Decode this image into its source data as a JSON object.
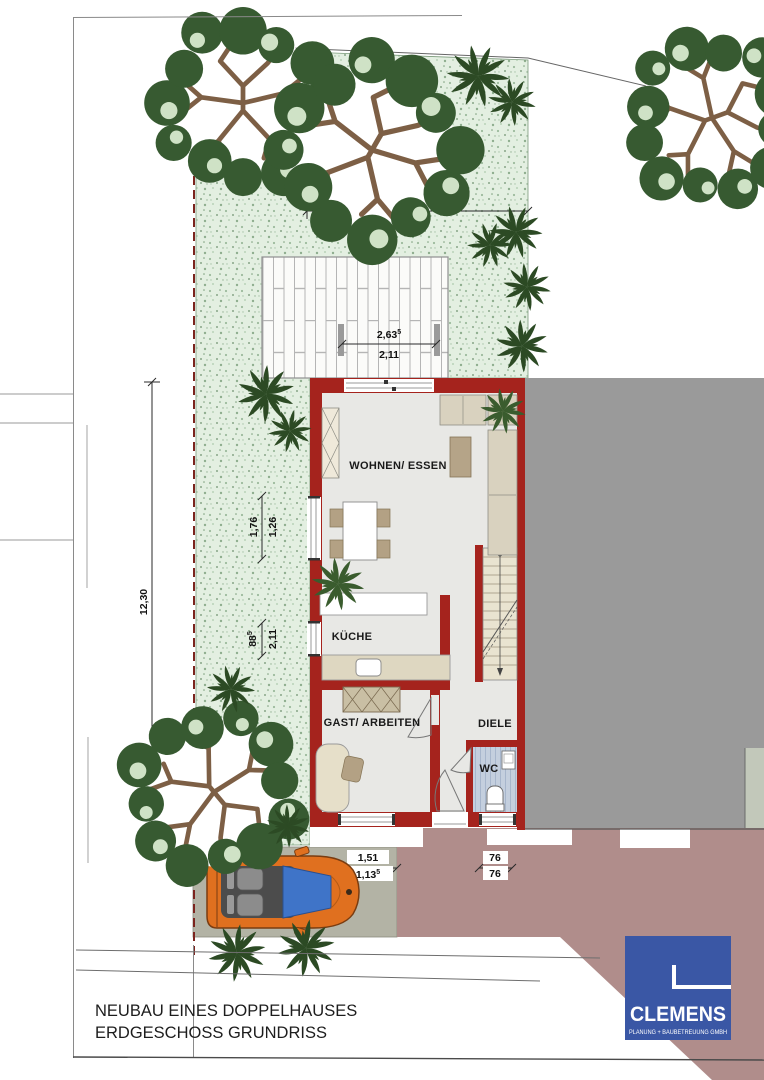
{
  "meta": {
    "drawing_type": "architectural floor plan / site plan"
  },
  "title_block": {
    "line1": "NEUBAU EINES DOPPELHAUSES",
    "line2": "ERDGESCHOSS GRUNDRISS"
  },
  "logo": {
    "name": "CLEMENS",
    "subtitle": "PLANUNG + BAUBETREUUNG GMBH"
  },
  "site": {
    "plot_label": "9/18"
  },
  "rooms": {
    "living": "WOHNEN/ ESSEN",
    "kitchen": "KÜCHE",
    "guest": "GAST/ ARBEITEN",
    "hall": "DIELE",
    "wc": "WC"
  },
  "dimensions": {
    "garden_width": "6,00",
    "garden_depth": "12,30",
    "terrace_upper": {
      "value": "2,63",
      "sup": "5"
    },
    "terrace_lower": "2,11",
    "living_window_upper": "1,76",
    "living_window_lower": "1,26",
    "kitchen_window_upper": {
      "value": "88",
      "sup": "5"
    },
    "kitchen_window_lower": "2,11",
    "driveway_upper": "1,51",
    "driveway_lower": {
      "value": "1,13",
      "sup": "5"
    },
    "entry_upper": "76",
    "entry_lower": "76"
  },
  "colors": {
    "wall_red": "#a5231d",
    "garden_green": "#e3efe1",
    "neighbor_gray": "#9a9a9a",
    "driveway_gray": "#b3b3a5",
    "walkway_mauve": "#b08d8b",
    "logo_blue": "#3a57a5",
    "car_orange": "#e0701f"
  }
}
